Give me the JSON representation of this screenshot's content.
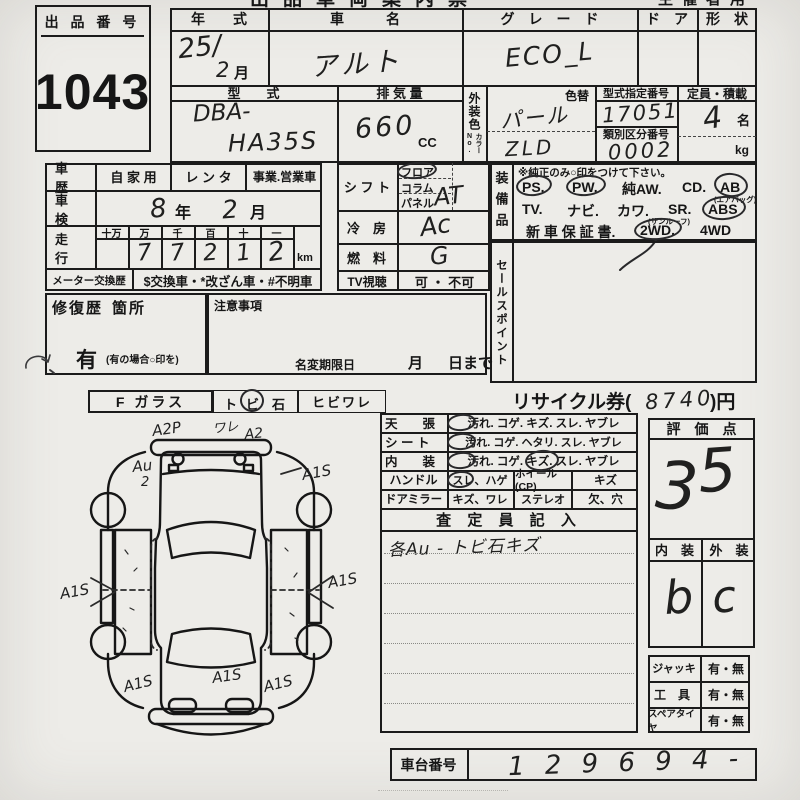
{
  "sheet": {
    "top_center_clipped": "出品車両案内票",
    "top_right_clipped": "主催者用"
  },
  "auction": {
    "label": "出 品 番 号",
    "number": "1043"
  },
  "vehicle": {
    "year_label": "年　　式",
    "year_value": "25/",
    "month_value": "2",
    "month_unit": "月",
    "name_label": "車　　　名",
    "name_value": "アルト",
    "grade_label": "グ　レ　ー　ド",
    "grade_value": "ECO_L",
    "door_label": "ド　ア",
    "shape_label": "形　状",
    "model_label": "型　　式",
    "model_prefix": "DBA-",
    "model_code": "HA35S",
    "disp_label": "排 気 量",
    "disp_value": "660",
    "disp_unit": "cc",
    "color_label": "外装色",
    "color_change_label": "色替",
    "color_no_label": "カラーNo.",
    "color_value": "パール",
    "color_code": "ZLD",
    "type_no_label": "型式指定番号",
    "type_no_value": "17051",
    "class_no_label": "類別区分番号",
    "class_no_value": "0002",
    "capacity_label": "定員・積載",
    "capacity_value": "4",
    "capacity_unit": "名",
    "capacity_kg": "kg"
  },
  "history": {
    "car_history_label": "車　歴",
    "usage_private": "自 家 用",
    "usage_rental": "レ ン タ",
    "usage_business": "事業.営業車",
    "inspection_label": "車　検",
    "inspection_year": "8",
    "year_unit": "年",
    "inspection_month": "2",
    "month_unit": "月",
    "mileage_label": "走　行",
    "mileage_units": [
      "十万",
      "万",
      "千",
      "百",
      "十",
      "一"
    ],
    "mileage_digits": [
      "",
      "7",
      "7",
      "2",
      "1",
      "2"
    ],
    "mileage_km": "km",
    "meter_label": "メーター交換歴",
    "meter_options": "$交換車・*改ざん車・#不明車"
  },
  "controls": {
    "shift_label": "シ フ ト",
    "shift_options": [
      "フロア",
      "コラム",
      "パネル"
    ],
    "shift_value": "AT",
    "ac_label": "冷　房",
    "ac_value": "Ac",
    "fuel_label": "燃　料",
    "fuel_value": "G",
    "tv_label": "TV視聴",
    "tv_options": "可 ・ 不可"
  },
  "equipment": {
    "label": "装備品",
    "note": "※純正のみ○印をつけて下さい。",
    "row1": [
      "PS.",
      "PW.",
      "純AW.",
      "CD.",
      "AB"
    ],
    "airbag_note": "(エアバッグ)",
    "row2": [
      "TV.",
      "ナビ.",
      "カワ.",
      "SR.",
      "ABS"
    ],
    "sunroof_note": "(サンルーフ)",
    "row3": [
      "新 車 保 証 書.",
      "2WD.",
      "4WD"
    ]
  },
  "sales_point_label": "セールスポイント",
  "repair": {
    "label": "修復歴",
    "spot_label": "箇所",
    "has_value": "有",
    "has_note": "(有の場合○印を)"
  },
  "caution": {
    "label": "注意事項",
    "rename_label": "名変期限日",
    "month_unit": "月",
    "day_unit": "日まで"
  },
  "glass": {
    "label": "F ガラス",
    "chip_prefix": "ト",
    "chip_circled": "ビ",
    "chip_suffix": "石",
    "crack": "ヒビワレ"
  },
  "recycle": {
    "prefix": "リサイクル券(",
    "value": "8740",
    "suffix": ")円"
  },
  "diagram": {
    "annotations": [
      "A2P",
      "ワレ",
      "A2",
      "Au",
      "2",
      "A1S",
      "A1S",
      "A1S",
      "A1S",
      "A1S",
      "A1S"
    ]
  },
  "condition": {
    "rows": [
      {
        "label": "天　　張",
        "options": "汚れ. コゲ. キズ. スレ. ヤブレ"
      },
      {
        "label": "シ ー ト",
        "options": "汚れ. コゲ. ヘタリ. スレ. ヤブレ"
      },
      {
        "label": "内　　装",
        "options": "汚れ. コゲ. キズ. スレ. ヤブレ"
      }
    ],
    "handle_label": "ハンドル",
    "handle_opt": "スレ、ハゲ",
    "wheel_label": "ホイール(CP)",
    "wheel_opt": "キズ",
    "mirror_label": "ドアミラー",
    "mirror_opt": "キズ、ワレ",
    "stereo_label": "ステレオ",
    "stereo_opt": "欠、穴"
  },
  "assessor": {
    "header": "査 定 員 記 入",
    "note": "各Au - トビ石キズ"
  },
  "score": {
    "header": "評　価　点",
    "digit1": "3",
    "digit2": "5",
    "interior_label": "内　装",
    "exterior_label": "外　装",
    "interior_value": "b",
    "exterior_value": "c"
  },
  "accessories": {
    "rows": [
      {
        "label": "ジャッキ",
        "value": "有・無"
      },
      {
        "label": "工　具",
        "value": "有・無"
      },
      {
        "label": "スペアタイヤ",
        "value": "有・無"
      }
    ]
  },
  "chassis": {
    "label": "車台番号",
    "value": "1 2 9 6 9 4 -"
  }
}
